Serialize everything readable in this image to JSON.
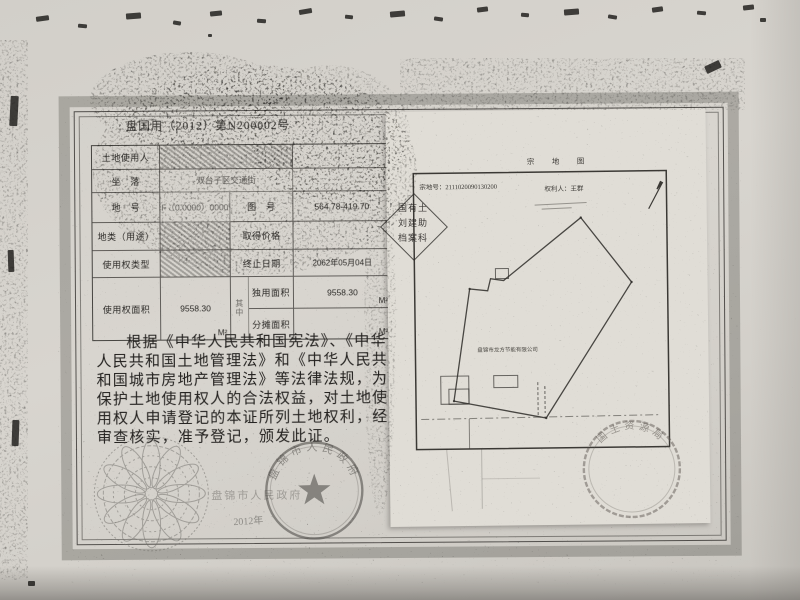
{
  "certificate": {
    "number": "盘国用（2012）第N200002号",
    "table": {
      "row1_label": "土地使用人",
      "row1_value": "",
      "row2_label": "坐　落",
      "row2_value": "双台子区交通街",
      "row3_label": "地　号",
      "row3_value": "F（0.0000）0000",
      "row3_label2": "图　号",
      "row3_value2": "564.78-419.70",
      "row4_label": "地类（用途）",
      "row4_value": "",
      "row4_label2": "取得价格",
      "row4_value2": "",
      "row5_label": "使用权类型",
      "row5_value": "",
      "row5_label2": "终止日期",
      "row5_value2": "2062年05月04日",
      "row6_label": "使用权面积",
      "row6_value": "9558.30",
      "row6_unit": "M²",
      "row6_mid": "其中",
      "row6_label2": "独用面积",
      "row6_value2": "9558.30",
      "row6_unit2": "M²",
      "row7_label2": "分摊面积",
      "row7_value2": "",
      "row7_unit2": "M²"
    },
    "body_lines": [
      "根据《中华人民共和国宪法》、《中华",
      "人民共和国土地管理法》和《中华人民共",
      "和国城市房地产管理法》等法律法规，为",
      "保护土地使用权人的合法权益，对土地使",
      "用权人申请登记的本证所列土地权利，经",
      "审查核实，准予登记，颁发此证。"
    ],
    "issuer_seal_text": "盘锦市人民政府",
    "issuer_line": "盘锦市人民政府",
    "issue_date_partial": "2012年"
  },
  "map_sheet": {
    "title": "宗　地　图",
    "parcel_no_label": "宗地号：",
    "parcel_no": "2111020090130200",
    "holder_label": "权利人：",
    "holder": "王群",
    "company": "盘锦市龙方节能有限公司",
    "stamp_text": "国土资源局"
  },
  "diamond_stamp": {
    "line1": "国有土",
    "line2": "刘建助",
    "line3": "档案科"
  }
}
